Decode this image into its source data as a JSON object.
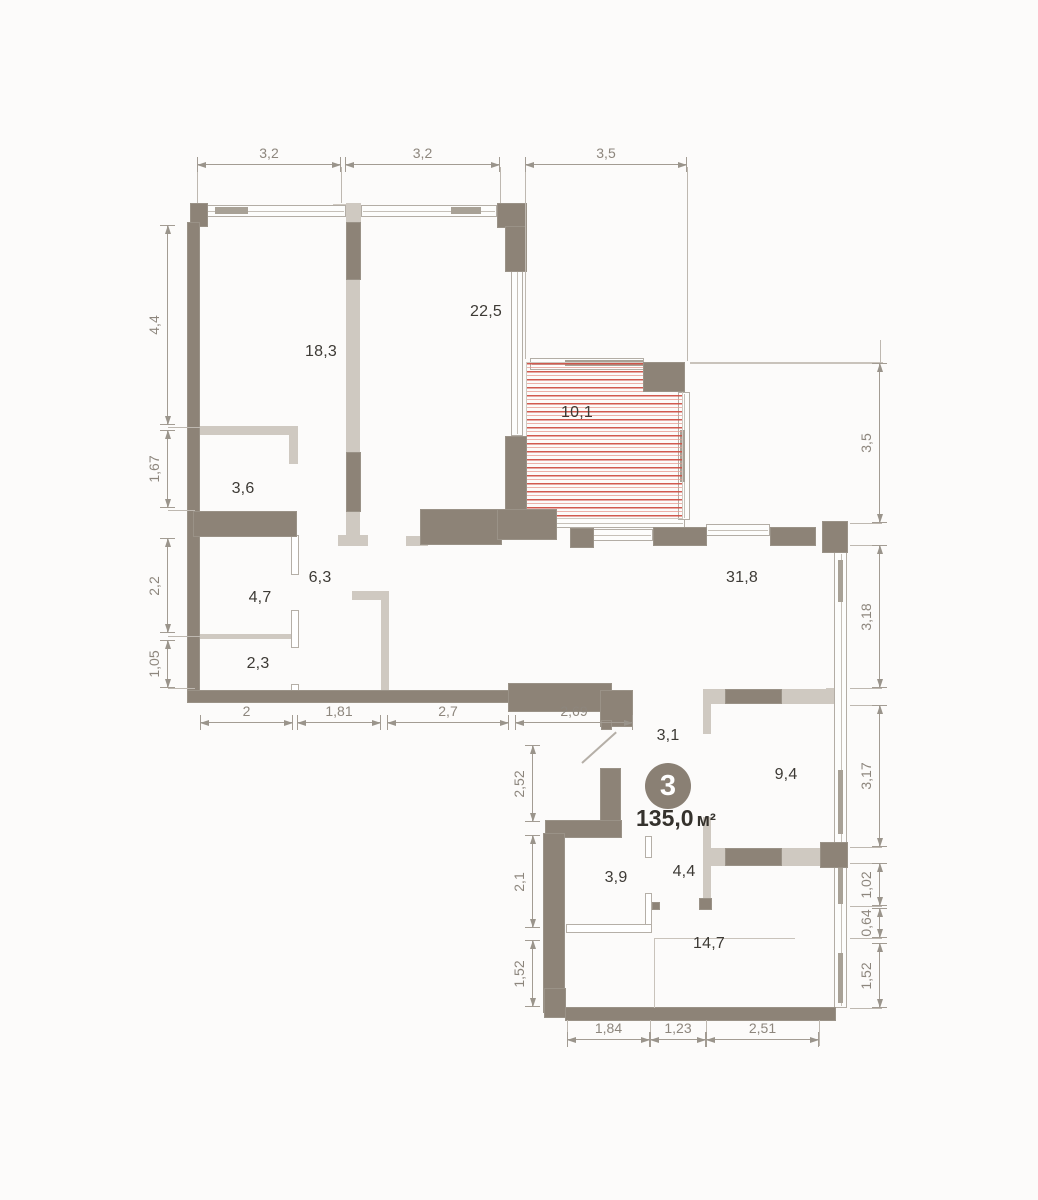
{
  "plan": {
    "unit_number": "3",
    "total_area_value": "135,0",
    "total_area_unit": "м²",
    "rooms": [
      {
        "area": "18,3",
        "x": 321,
        "y": 352
      },
      {
        "area": "22,5",
        "x": 486,
        "y": 312
      },
      {
        "area": "10,1",
        "x": 577,
        "y": 413
      },
      {
        "area": "3,6",
        "x": 243,
        "y": 489
      },
      {
        "area": "6,3",
        "x": 320,
        "y": 578
      },
      {
        "area": "4,7",
        "x": 260,
        "y": 598
      },
      {
        "area": "2,3",
        "x": 258,
        "y": 664
      },
      {
        "area": "31,8",
        "x": 742,
        "y": 578
      },
      {
        "area": "3,1",
        "x": 668,
        "y": 736
      },
      {
        "area": "9,4",
        "x": 786,
        "y": 775
      },
      {
        "area": "3,9",
        "x": 616,
        "y": 878
      },
      {
        "area": "4,4",
        "x": 684,
        "y": 872
      },
      {
        "area": "14,7",
        "x": 709,
        "y": 944
      }
    ],
    "dimensions": {
      "horizontal": [
        {
          "value": "3,2",
          "x1": 197,
          "x2": 341,
          "y": 165
        },
        {
          "value": "3,2",
          "x1": 345,
          "x2": 500,
          "y": 165
        },
        {
          "value": "3,5",
          "x1": 525,
          "x2": 687,
          "y": 165
        },
        {
          "value": "2",
          "x1": 200,
          "x2": 293,
          "y": 723
        },
        {
          "value": "1,81",
          "x1": 297,
          "x2": 381,
          "y": 723
        },
        {
          "value": "2,7",
          "x1": 387,
          "x2": 509,
          "y": 723
        },
        {
          "value": "2,69",
          "x1": 515,
          "x2": 633,
          "y": 723
        },
        {
          "value": "1,84",
          "x1": 567,
          "x2": 650,
          "y": 1040
        },
        {
          "value": "1,23",
          "x1": 650,
          "x2": 706,
          "y": 1040
        },
        {
          "value": "2,51",
          "x1": 706,
          "x2": 819,
          "y": 1040
        }
      ],
      "vertical": [
        {
          "value": "4,4",
          "y1": 225,
          "y2": 425,
          "x": 168
        },
        {
          "value": "1,67",
          "y1": 430,
          "y2": 508,
          "x": 168
        },
        {
          "value": "2,2",
          "y1": 538,
          "y2": 633,
          "x": 168
        },
        {
          "value": "1,05",
          "y1": 640,
          "y2": 688,
          "x": 168
        },
        {
          "value": "3,5",
          "y1": 363,
          "y2": 523,
          "x": 880
        },
        {
          "value": "3,18",
          "y1": 545,
          "y2": 688,
          "x": 880
        },
        {
          "value": "3,17",
          "y1": 705,
          "y2": 847,
          "x": 880
        },
        {
          "value": "1,02",
          "y1": 863,
          "y2": 906,
          "x": 880
        },
        {
          "value": "0,64",
          "y1": 908,
          "y2": 938,
          "x": 880
        },
        {
          "value": "1,52",
          "y1": 943,
          "y2": 1008,
          "x": 880
        },
        {
          "value": "2,52",
          "y1": 745,
          "y2": 822,
          "x": 533
        },
        {
          "value": "2,1",
          "y1": 835,
          "y2": 928,
          "x": 533
        },
        {
          "value": "1,52",
          "y1": 940,
          "y2": 1007,
          "x": 533
        }
      ]
    },
    "colors": {
      "wall_dark": "#8d8377",
      "wall_light": "#cfc9c1",
      "hatch_red": "#cf5146",
      "dimension_text": "#8d867d",
      "room_text": "#3d3a35",
      "badge_fill": "#8a8074",
      "badge_text": "#ffffff"
    }
  }
}
